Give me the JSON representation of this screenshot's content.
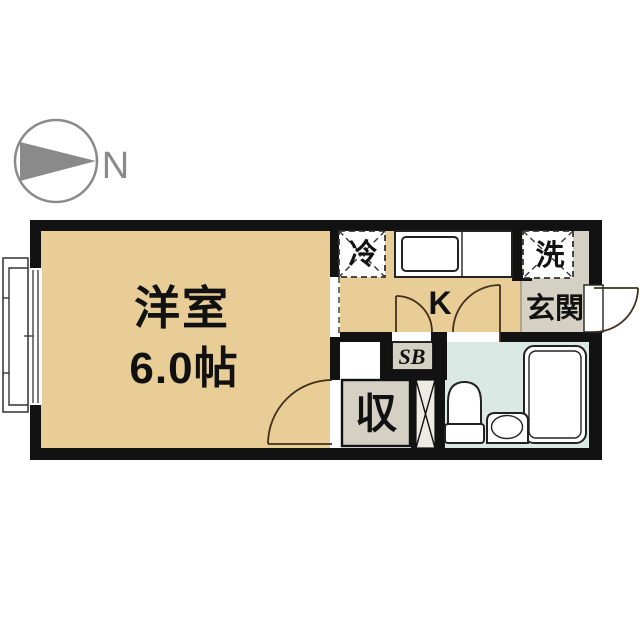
{
  "compass": {
    "north_label": "N"
  },
  "rooms": {
    "western_room": {
      "name": "洋室",
      "size": "6.0帖"
    },
    "kitchen": {
      "label": "K"
    },
    "entrance": {
      "label": "玄関"
    },
    "washer": {
      "label": "洗"
    },
    "refrigerator": {
      "label": "冷"
    },
    "shoe_box": {
      "label": "SB"
    },
    "storage": {
      "label": "収"
    }
  },
  "colors": {
    "wall": "#121212",
    "floor_main_room": "#e8cd96",
    "floor_kitchen": "#e8cd96",
    "floor_entrance": "#d4d1c4",
    "floor_bathroom": "#dbe9e4",
    "floor_shaft": "#edece4",
    "door_arc": "#40301c",
    "compass": "#8a8a8a"
  }
}
